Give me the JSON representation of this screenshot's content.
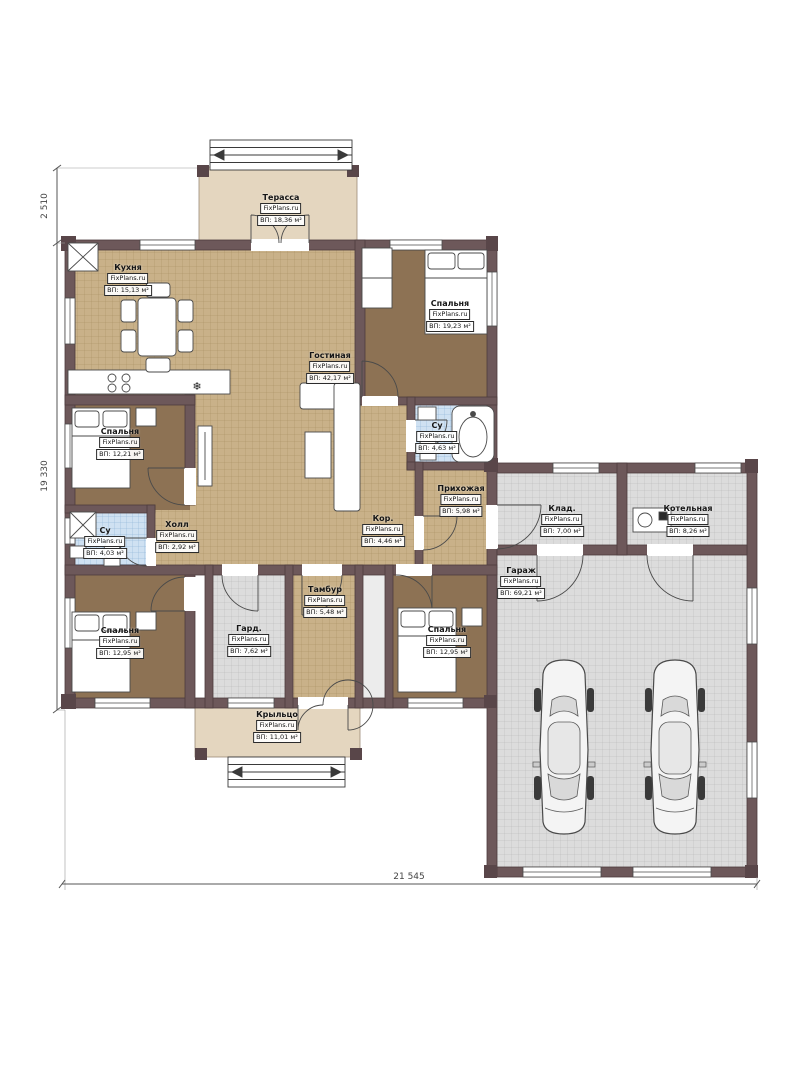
{
  "watermark": "FixPlans.ru",
  "dimensions": {
    "terrace_depth": "2 510",
    "house_side": "19 330",
    "total_width": "21 545"
  },
  "icons": {
    "snowflake": "❄"
  },
  "colors": {
    "wall": "#6d585a",
    "floor_wood": "#c9b189",
    "floor_bedroom": "#8d7254",
    "floor_bath": "#cfe1f2",
    "floor_garage": "#dcdcdc",
    "terrace": "#e4d6bf"
  },
  "rooms": {
    "terrace": {
      "name": "Терасса",
      "area": "ВП: 18,36 м²"
    },
    "kitchen": {
      "name": "Кухня",
      "area": "ВП: 15,13 м²"
    },
    "living": {
      "name": "Гостиная",
      "area": "ВП: 42,17 м²"
    },
    "bedroom_tr": {
      "name": "Спальня",
      "area": "ВП: 19,23 м²"
    },
    "bedroom_l": {
      "name": "Спальня",
      "area": "ВП: 12,21 м²"
    },
    "bath_r": {
      "name": "Су",
      "area": "ВП: 4,63 м²"
    },
    "entry": {
      "name": "Прихожая",
      "area": "ВП: 5,98 м²"
    },
    "hall": {
      "name": "Холл",
      "area": "ВП: 2,92 м²"
    },
    "corridor": {
      "name": "Кор.",
      "area": "ВП: 4,46 м²"
    },
    "bath_l": {
      "name": "Су",
      "area": "ВП: 4,03 м²"
    },
    "bedroom_bl": {
      "name": "Спальня",
      "area": "ВП: 12,95 м²"
    },
    "wardrobe": {
      "name": "Гард.",
      "area": "ВП: 7,62 м²"
    },
    "tambour": {
      "name": "Тамбур",
      "area": "ВП: 5,48 м²"
    },
    "bedroom_br": {
      "name": "Спальня",
      "area": "ВП: 12,95 м²"
    },
    "porch": {
      "name": "Крыльцо",
      "area": "ВП: 11,01 м²"
    },
    "garage": {
      "name": "Гараж",
      "area": "ВП: 69,21 м²"
    },
    "storage": {
      "name": "Клад.",
      "area": "ВП: 7,00 м²"
    },
    "boiler": {
      "name": "Котельная",
      "area": "ВП: 8,26 м²"
    }
  }
}
